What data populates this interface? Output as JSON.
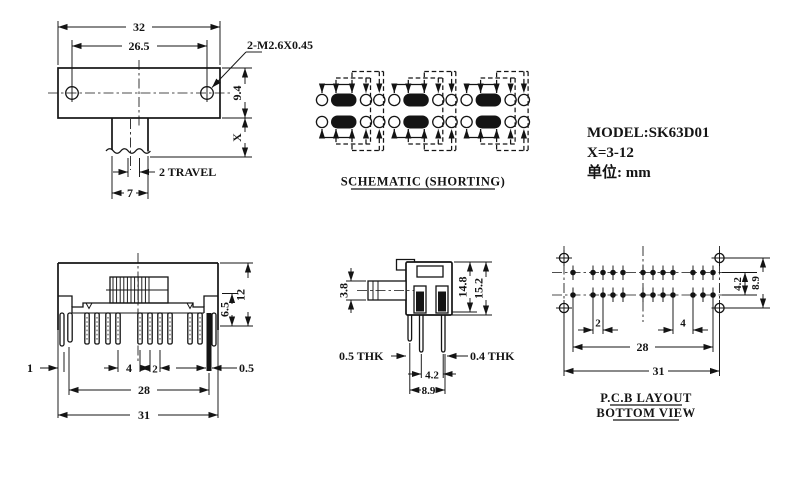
{
  "colors": {
    "ink": "#141414",
    "background": "#ffffff"
  },
  "top_view": {
    "dims": {
      "overall_width": "32",
      "hole_spacing": "26.5",
      "screw_spec": "2-M2.6X0.45",
      "body_height": "9.4",
      "shaft_height": "X",
      "travel": "2 TRAVEL",
      "shaft_width": "7"
    }
  },
  "schematic": {
    "caption": "SCHEMATIC (SHORTING)"
  },
  "model_info": {
    "model": "MODEL:SK63D01",
    "x_range": "X=3-12",
    "unit": "单位: mm"
  },
  "front_view": {
    "dims": {
      "overall_height": "12",
      "body_height": "6.5",
      "tab_width": "1",
      "pin_gap_4": "4",
      "pin_pitch_2": "2",
      "pin_thickness": "0.5",
      "pin_span": "28",
      "overall_width": "31"
    }
  },
  "side_view": {
    "dims": {
      "knob_height": "3.8",
      "height_inner": "14.8",
      "height_outer": "15.2",
      "thk_left": "0.5 THK",
      "thk_right": "0.4 THK",
      "leg_pitch": "4.2",
      "leg_span": "8.9"
    }
  },
  "pcb_layout": {
    "caption_line1": "P.C.B LAYOUT",
    "caption_line2": "BOTTOM VIEW",
    "dims": {
      "pad_pitch_2": "2",
      "pad_gap_4": "4",
      "pad_span": "28",
      "hole_span": "31",
      "row_pitch": "4.2",
      "hole_row_span": "8.9"
    }
  }
}
